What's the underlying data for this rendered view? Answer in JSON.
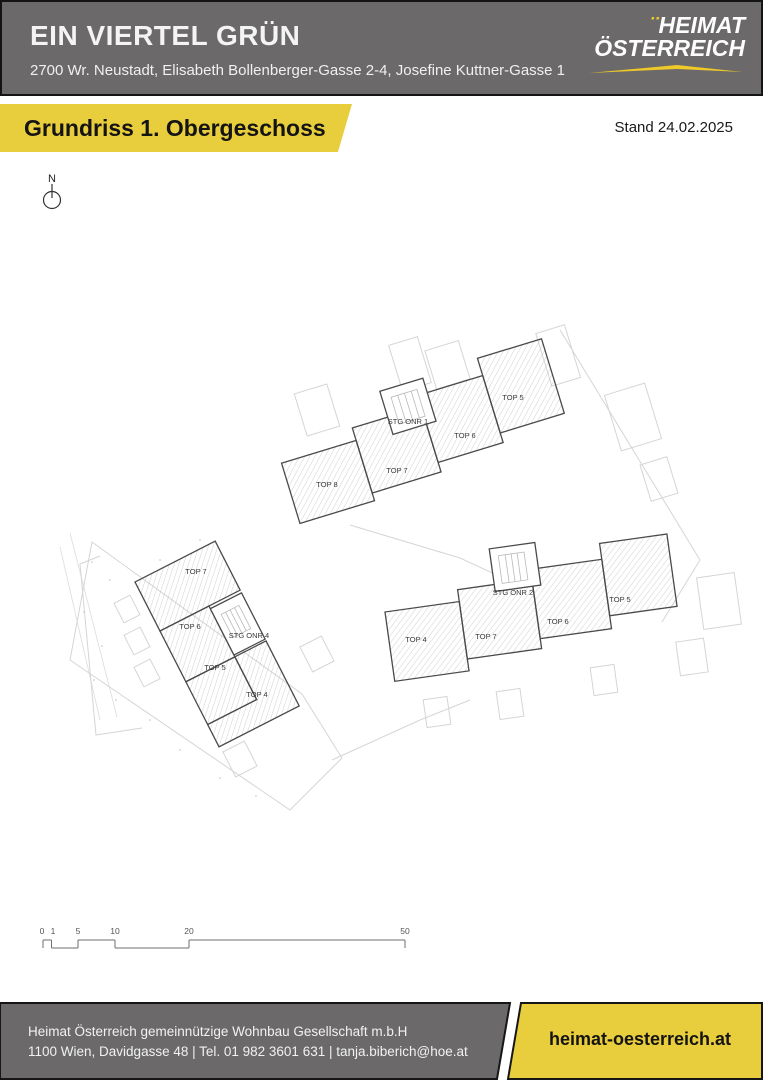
{
  "header": {
    "title": "EIN VIERTEL GRÜN",
    "address": "2700 Wr. Neustadt, Elisabeth Bollenberger-Gasse 2-4, Josefine Kuttner-Gasse 1",
    "logo": {
      "line1": "HEIMAT",
      "line2": "ÖSTERREICH",
      "dots": "¨"
    }
  },
  "banner": {
    "title": "Grundriss 1. Obergeschoss",
    "stand": "Stand 24.02.2025"
  },
  "plan": {
    "north_label": "N",
    "buildings": [
      {
        "name": "stiege-1",
        "stair_label": "STG ONR 1",
        "units": [
          "TOP 8",
          "TOP 7",
          "TOP 6",
          "TOP 5"
        ]
      },
      {
        "name": "stiege-4",
        "stair_label": "STG ONR 4",
        "units": [
          "TOP 7",
          "TOP 6",
          "TOP 5",
          "TOP 4"
        ]
      },
      {
        "name": "stiege-2",
        "stair_label": "STG ONR 2",
        "units": [
          "TOP 4",
          "TOP 7",
          "TOP 6",
          "TOP 5"
        ]
      }
    ],
    "scale_labels": [
      "0",
      "1",
      "5",
      "10",
      "20",
      "50"
    ]
  },
  "footer": {
    "company": "Heimat Österreich gemeinnützige Wohnbau Gesellschaft m.b.H",
    "contact": "1100 Wien, Davidgasse 48 | Tel. 01 982 3601 631 | tanja.biberich@hoe.at",
    "website": "heimat-oesterreich.at"
  },
  "colors": {
    "header_gray": "#6b6969",
    "brand_yellow": "#e8cd3c",
    "logo_yellow": "#eec928",
    "plan_dark_line": "#4a4a4a",
    "plan_faint_line": "#d5d5d5"
  }
}
